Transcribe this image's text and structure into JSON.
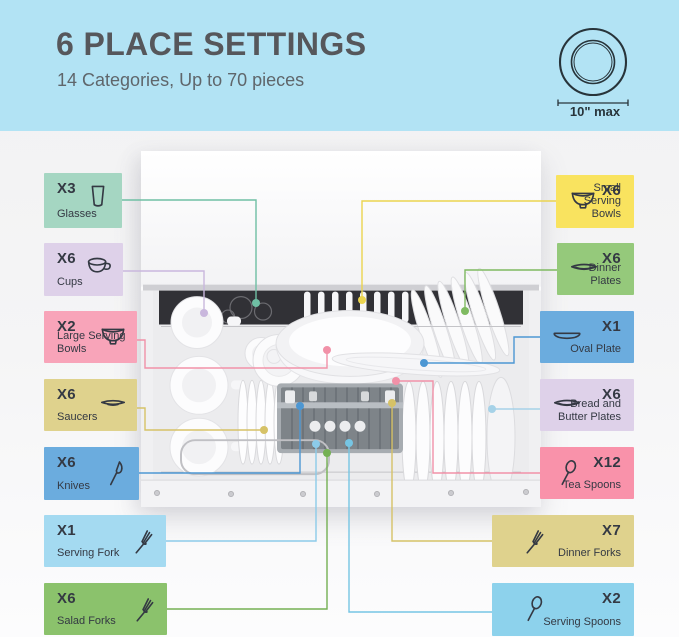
{
  "header": {
    "title": "6 PLACE SETTINGS",
    "subtitle": "14 Categories, Up to 70 pieces",
    "bg_color": "#B2E3F4",
    "title_color": "#56575B",
    "plate_badge": {
      "icon": "plate-top-view-icon",
      "label": "10\" max"
    }
  },
  "items": [
    {
      "id": "glasses",
      "count": "X3",
      "label": "Glasses",
      "side": "left",
      "icon": "glass",
      "color": "#A5D6C2",
      "line_color": "#6FBFA4",
      "box": [
        44,
        173,
        78,
        55
      ],
      "path": [
        [
          122,
          200
        ],
        [
          256,
          200
        ],
        [
          256,
          303
        ]
      ]
    },
    {
      "id": "cups",
      "count": "X6",
      "label": "Cups",
      "side": "left",
      "icon": "cup",
      "color": "#DED1E9",
      "line_color": "#C9B7DD",
      "box": [
        44,
        243,
        79,
        53
      ],
      "path": [
        [
          123,
          271
        ],
        [
          204,
          271
        ],
        [
          204,
          313
        ]
      ]
    },
    {
      "id": "large-serving-bowls",
      "count": "X2",
      "label": "Large Serving Bowls",
      "side": "left",
      "icon": "bowl",
      "color": "#F8A4B9",
      "line_color": "#F191A8",
      "box": [
        44,
        311,
        93,
        52
      ],
      "path": [
        [
          137,
          340
        ],
        [
          145,
          340
        ],
        [
          145,
          368
        ],
        [
          327,
          368
        ],
        [
          327,
          350
        ]
      ]
    },
    {
      "id": "saucers",
      "count": "X6",
      "label": "Saucers",
      "side": "left",
      "icon": "saucer",
      "color": "#DFD28D",
      "line_color": "#D6C267",
      "box": [
        44,
        379,
        93,
        52
      ],
      "path": [
        [
          137,
          408
        ],
        [
          145,
          408
        ],
        [
          145,
          430
        ],
        [
          264,
          430
        ]
      ]
    },
    {
      "id": "knives",
      "count": "X6",
      "label": "Knives",
      "side": "left",
      "icon": "knife",
      "color": "#6BACDE",
      "line_color": "#4D97D3",
      "box": [
        44,
        447,
        95,
        53
      ],
      "path": [
        [
          139,
          473
        ],
        [
          300,
          473
        ],
        [
          300,
          406
        ]
      ]
    },
    {
      "id": "serving-fork",
      "count": "X1",
      "label": "Serving Fork",
      "side": "left",
      "icon": "fork",
      "color": "#A4DAF1",
      "line_color": "#8CCBE9",
      "box": [
        44,
        515,
        122,
        52
      ],
      "path": [
        [
          166,
          541
        ],
        [
          316,
          541
        ],
        [
          316,
          444
        ]
      ]
    },
    {
      "id": "salad-forks",
      "count": "X6",
      "label": "Salad Forks",
      "side": "left",
      "icon": "fork",
      "color": "#8BC26C",
      "line_color": "#74B053",
      "box": [
        44,
        583,
        123,
        52
      ],
      "path": [
        [
          167,
          609
        ],
        [
          327,
          609
        ],
        [
          327,
          453
        ]
      ]
    },
    {
      "id": "small-serving-bowls",
      "count": "X6",
      "label": "Small Serving Bowls",
      "side": "right",
      "icon": "bowl",
      "color": "#F9E35F",
      "line_color": "#EBD44F",
      "box": [
        556,
        175,
        78,
        53
      ],
      "path": [
        [
          556,
          201
        ],
        [
          362,
          201
        ],
        [
          362,
          300
        ]
      ]
    },
    {
      "id": "dinner-plates",
      "count": "X6",
      "label": "Dinner Plates",
      "side": "right",
      "icon": "plate",
      "color": "#95C97B",
      "line_color": "#7FBA61",
      "box": [
        557,
        243,
        77,
        52
      ],
      "path": [
        [
          557,
          270
        ],
        [
          465,
          270
        ],
        [
          465,
          311
        ]
      ]
    },
    {
      "id": "oval-plate",
      "count": "X1",
      "label": "Oval Plate",
      "side": "right",
      "icon": "oval-plate",
      "color": "#6BACDE",
      "line_color": "#4D97D3",
      "box": [
        540,
        311,
        94,
        52
      ],
      "path": [
        [
          540,
          337
        ],
        [
          514,
          337
        ],
        [
          514,
          363
        ],
        [
          424,
          363
        ]
      ]
    },
    {
      "id": "bread-and-butter-plates",
      "count": "X6",
      "label": "Bread and Butter Plates",
      "side": "right",
      "icon": "plate",
      "color": "#DED1E9",
      "line_color": "#A6D2E8",
      "box": [
        540,
        379,
        94,
        52
      ],
      "path": [
        [
          540,
          409
        ],
        [
          492,
          409
        ]
      ]
    },
    {
      "id": "tea-spoons",
      "count": "X12",
      "label": "Tea Spoons",
      "side": "right",
      "icon": "spoon",
      "color": "#F992AA",
      "line_color": "#F191A8",
      "box": [
        540,
        447,
        94,
        52
      ],
      "path": [
        [
          540,
          473
        ],
        [
          433,
          473
        ],
        [
          433,
          381
        ],
        [
          396,
          381
        ]
      ]
    },
    {
      "id": "dinner-forks",
      "count": "X7",
      "label": "Dinner Forks",
      "side": "right",
      "icon": "fork",
      "color": "#DFD28D",
      "line_color": "#D6C267",
      "box": [
        492,
        515,
        142,
        52
      ],
      "path": [
        [
          492,
          541
        ],
        [
          392,
          541
        ],
        [
          392,
          403
        ]
      ]
    },
    {
      "id": "serving-spoons",
      "count": "X2",
      "label": "Serving Spoons",
      "side": "right",
      "icon": "spoon",
      "color": "#8DD2EC",
      "line_color": "#76C5E3",
      "box": [
        492,
        583,
        142,
        53
      ],
      "path": [
        [
          492,
          612
        ],
        [
          349,
          612
        ],
        [
          349,
          443
        ]
      ]
    }
  ]
}
